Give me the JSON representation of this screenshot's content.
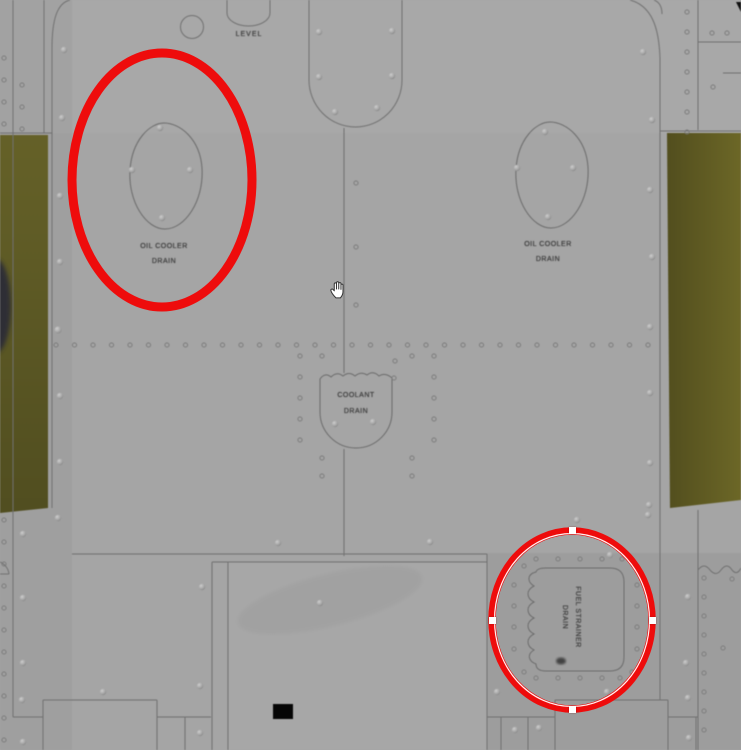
{
  "diagram_labels": {
    "level": "LEVEL",
    "oil_cooler_left": {
      "line1": "OIL COOLER",
      "line2": "DRAIN"
    },
    "oil_cooler_right": {
      "line1": "OIL COOLER",
      "line2": "DRAIN"
    },
    "coolant_drain": {
      "line1": "COOLANT",
      "line2": "DRAIN"
    },
    "fuel_strainer": {
      "line1": "FUEL STRAINER",
      "line2": "DRAIN"
    }
  },
  "annotations": {
    "stroke_color": "#ee0c0c",
    "handle_color": "#ffffff",
    "left_ellipse": {
      "cx": 162,
      "cy": 180,
      "rx": 90,
      "ry": 127,
      "stroke_width": 9,
      "selected": false
    },
    "right_ellipse": {
      "cx": 572,
      "cy": 620,
      "rx": 80,
      "ry": 89,
      "stroke_width": 7.5,
      "selected": true
    }
  },
  "cursor": {
    "type": "hand",
    "x": 330,
    "y": 282
  },
  "colors": {
    "background": "#a5a5a5",
    "panel_line": "#707070",
    "wing_olive_left": "#5d5a26",
    "wing_olive_right": "#635e24",
    "label_text": "#3e3e3e",
    "annotation_red": "#ee0c0c"
  }
}
